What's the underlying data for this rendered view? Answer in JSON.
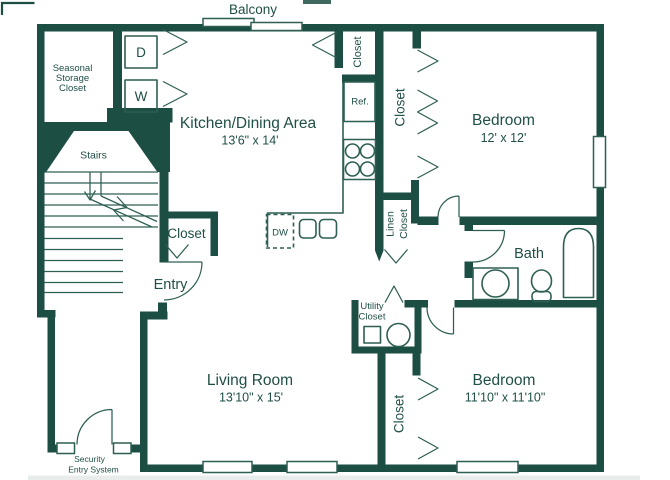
{
  "colors": {
    "wall": "#1d4e43",
    "line": "#2e5f53",
    "text": "#1f4f46",
    "bg": "#ffffff"
  },
  "plan": {
    "balcony": {
      "label": "Balcony"
    },
    "seasonal_storage_closet": {
      "line1": "Seasonal",
      "line2": "Storage",
      "line3": "Closet"
    },
    "dryer": {
      "label": "D"
    },
    "washer": {
      "label": "W"
    },
    "kitchen_dining": {
      "label": "Kitchen/Dining Area",
      "dims": "13'6\" x 14'"
    },
    "pantry_closet": {
      "label": "Closet"
    },
    "stairs": {
      "label": "Stairs"
    },
    "entry_closet": {
      "label": "Closet"
    },
    "entry": {
      "label": "Entry"
    },
    "refrigerator": {
      "label": "Ref."
    },
    "dishwasher": {
      "label": "DW"
    },
    "bedroom1": {
      "label": "Bedroom",
      "dims": "12' x 12'"
    },
    "bedroom1_closet": {
      "label": "Closet"
    },
    "linen_closet": {
      "line1": "Linen",
      "line2": "Closet"
    },
    "bath": {
      "label": "Bath"
    },
    "utility_closet": {
      "line1": "Utility",
      "line2": "Closet"
    },
    "bedroom2": {
      "label": "Bedroom",
      "dims": "11'10\" x 11'10\""
    },
    "bedroom2_closet": {
      "label": "Closet"
    },
    "living_room": {
      "label": "Living Room",
      "dims": "13'10\" x 15'"
    },
    "security_system": {
      "line1": "Security",
      "line2": "Entry System"
    }
  }
}
